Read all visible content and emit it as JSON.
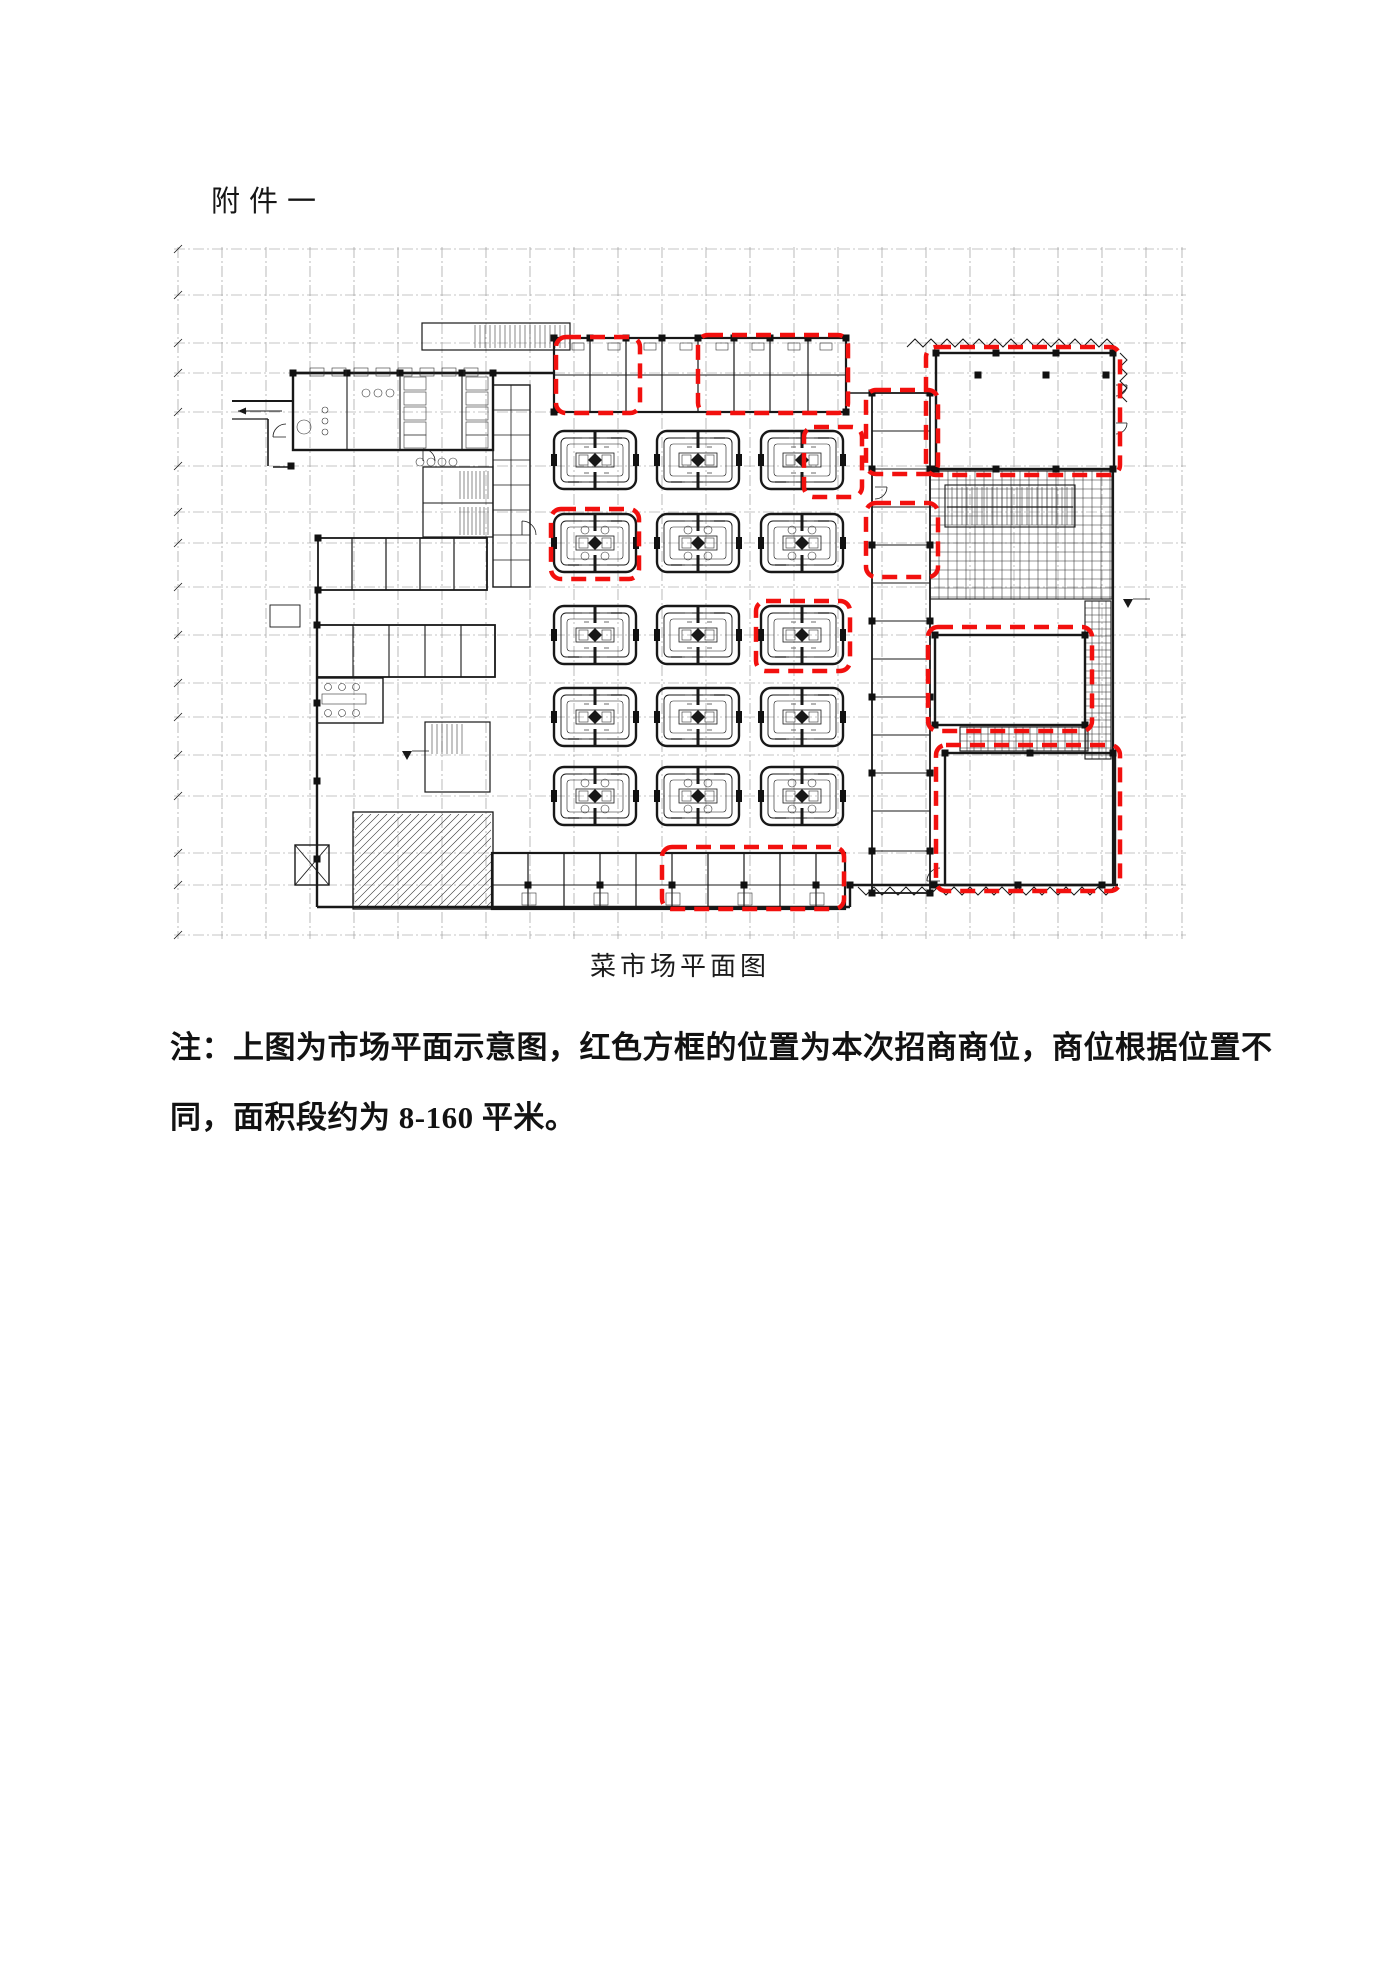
{
  "document": {
    "attachment_title": "附件一",
    "figure_caption": "菜市场平面图",
    "note_line1": "注：上图为市场平面示意图，红色方框的位置为本次招商商位，商位根据位置不",
    "note_line2": "同，面积段约为 8-160 平米。"
  },
  "floorplan": {
    "width": 1020,
    "height": 715,
    "colors": {
      "wall": "#181818",
      "grid": "#8e8e8e",
      "red": "#f2100e",
      "hatch": "#2a2a2a"
    },
    "grid": {
      "verticals": [
        8,
        52,
        96,
        140,
        184,
        228,
        272,
        316,
        360,
        404,
        448,
        492,
        536,
        580,
        624,
        668,
        712,
        756,
        800,
        844,
        888,
        932,
        976,
        1012
      ],
      "horizontals": [
        14,
        60,
        108,
        138,
        177,
        231,
        277,
        308,
        352,
        400,
        448,
        482,
        520,
        561,
        618,
        650,
        700
      ],
      "vy": [
        12,
        704
      ],
      "hx": [
        4,
        1016
      ],
      "tick_x": 8
    },
    "wall_rects": [
      [
        123,
        138,
        200,
        77,
        2.4
      ],
      [
        252,
        88,
        148,
        27,
        1.2
      ],
      [
        384,
        103,
        292,
        74,
        2.2
      ],
      [
        766,
        118,
        178,
        116,
        2.4
      ],
      [
        702,
        158,
        58,
        500,
        1.8
      ],
      [
        148,
        303,
        169,
        52,
        1.8
      ],
      [
        147,
        390,
        178,
        52,
        1.8
      ],
      [
        147,
        443,
        66,
        45,
        1.4
      ],
      [
        322,
        618,
        353,
        56,
        2.2
      ],
      [
        183,
        577,
        140,
        97,
        1.3
      ],
      [
        253,
        232,
        70,
        70,
        1.2
      ],
      [
        255,
        487,
        65,
        70,
        1.2
      ],
      [
        765,
        400,
        150,
        90,
        2.4
      ],
      [
        775,
        518,
        170,
        132,
        2.4
      ],
      [
        100,
        370,
        30,
        22,
        0.9
      ],
      [
        323,
        150,
        37,
        202,
        1.4
      ],
      [
        775,
        250,
        130,
        42,
        1.1
      ]
    ],
    "wall_lines": [
      [
        123,
        138,
        384,
        138,
        2.4
      ],
      [
        98,
        184,
        98,
        231,
        1.6
      ],
      [
        62,
        166,
        123,
        166,
        2.0
      ],
      [
        62,
        184,
        98,
        184,
        1.2
      ],
      [
        103,
        232,
        123,
        232,
        1.4
      ],
      [
        147,
        355,
        147,
        672,
        2.4
      ],
      [
        147,
        672,
        680,
        672,
        2.4
      ],
      [
        680,
        672,
        680,
        650,
        2.4
      ],
      [
        680,
        650,
        948,
        650,
        2.4
      ],
      [
        943,
        234,
        943,
        650,
        2.2
      ],
      [
        676,
        158,
        702,
        158,
        1.4
      ],
      [
        253,
        268,
        323,
        268,
        1.0
      ],
      [
        322,
        650,
        675,
        650,
        0.9
      ],
      [
        384,
        140,
        676,
        140,
        0.9
      ],
      [
        777,
        272,
        903,
        272,
        1.2
      ]
    ],
    "divider_sets": [
      {
        "o": "v",
        "xs": [
          420,
          456,
          492,
          528,
          564,
          600,
          638
        ],
        "a": 103,
        "b": 177,
        "w": 1.2
      },
      {
        "o": "v",
        "xs": [
          358,
          394,
          430,
          466,
          502,
          538,
          574,
          610,
          646
        ],
        "a": 618,
        "b": 674,
        "w": 1.2
      },
      {
        "o": "v",
        "xs": [
          182,
          216,
          250,
          284
        ],
        "a": 303,
        "b": 355,
        "w": 1.2
      },
      {
        "o": "v",
        "xs": [
          183,
          219,
          255,
          291
        ],
        "a": 390,
        "b": 442,
        "w": 1.1
      },
      {
        "o": "h",
        "ys": [
          196,
          234,
          272,
          310,
          348,
          386,
          424,
          462,
          500,
          538,
          576,
          616
        ],
        "a": 702,
        "b": 760,
        "w": 1.0
      },
      {
        "o": "h",
        "ys": [
          175,
          200,
          225,
          250,
          275,
          300,
          325
        ],
        "a": 323,
        "b": 360,
        "w": 0.8
      },
      {
        "o": "v",
        "xs": [
          177,
          230,
          292
        ],
        "a": 138,
        "b": 215,
        "w": 1.1
      },
      {
        "o": "v",
        "xs": [
          341
        ],
        "a": 150,
        "b": 352,
        "w": 0.8
      }
    ],
    "hatches": [
      [
        300,
        90,
        98,
        23,
        "v",
        5,
        0
      ],
      [
        760,
        236,
        182,
        128,
        "g",
        9,
        1
      ],
      [
        915,
        366,
        26,
        158,
        "g",
        7,
        1
      ],
      [
        790,
        492,
        128,
        24,
        "g",
        7,
        1
      ],
      [
        185,
        579,
        136,
        93,
        "d",
        8,
        0
      ],
      [
        286,
        236,
        34,
        28,
        "v",
        4,
        0
      ],
      [
        286,
        272,
        34,
        28,
        "v",
        4,
        0
      ],
      [
        257,
        489,
        40,
        30,
        "v",
        5,
        0
      ],
      [
        777,
        252,
        126,
        38,
        "v",
        5,
        0
      ]
    ],
    "squares": [
      [
        384,
        103
      ],
      [
        420,
        103
      ],
      [
        456,
        103
      ],
      [
        492,
        103
      ],
      [
        528,
        103
      ],
      [
        564,
        103
      ],
      [
        600,
        103
      ],
      [
        638,
        103
      ],
      [
        676,
        103
      ],
      [
        384,
        177
      ],
      [
        676,
        177
      ],
      [
        766,
        118
      ],
      [
        826,
        118
      ],
      [
        886,
        118
      ],
      [
        943,
        118
      ],
      [
        766,
        234
      ],
      [
        826,
        234
      ],
      [
        886,
        234
      ],
      [
        943,
        234
      ],
      [
        808,
        140
      ],
      [
        876,
        140
      ],
      [
        936,
        140
      ],
      [
        702,
        158
      ],
      [
        760,
        158
      ],
      [
        702,
        234
      ],
      [
        760,
        234
      ],
      [
        702,
        310
      ],
      [
        760,
        310
      ],
      [
        702,
        386
      ],
      [
        760,
        386
      ],
      [
        702,
        462
      ],
      [
        760,
        462
      ],
      [
        702,
        538
      ],
      [
        760,
        538
      ],
      [
        702,
        616
      ],
      [
        760,
        616
      ],
      [
        702,
        658
      ],
      [
        760,
        658
      ],
      [
        147,
        390
      ],
      [
        147,
        468
      ],
      [
        147,
        546
      ],
      [
        147,
        624
      ],
      [
        148,
        303
      ],
      [
        148,
        355
      ],
      [
        123,
        138
      ],
      [
        177,
        138
      ],
      [
        230,
        138
      ],
      [
        292,
        138
      ],
      [
        323,
        138
      ],
      [
        358,
        650
      ],
      [
        430,
        650
      ],
      [
        502,
        650
      ],
      [
        574,
        650
      ],
      [
        646,
        650
      ],
      [
        680,
        650
      ],
      [
        764,
        650
      ],
      [
        848,
        650
      ],
      [
        932,
        650
      ],
      [
        765,
        400
      ],
      [
        915,
        400
      ],
      [
        765,
        490
      ],
      [
        915,
        490
      ],
      [
        775,
        518
      ],
      [
        860,
        518
      ],
      [
        943,
        518
      ],
      [
        121,
        231
      ]
    ],
    "circles": [
      [
        134,
        192,
        7
      ],
      [
        155,
        175,
        3
      ],
      [
        155,
        186,
        3
      ],
      [
        155,
        197,
        3
      ],
      [
        196,
        158,
        4
      ],
      [
        208,
        158,
        4
      ],
      [
        220,
        158,
        4
      ],
      [
        250,
        227,
        4
      ],
      [
        261,
        227,
        4
      ],
      [
        272,
        227,
        4
      ],
      [
        283,
        227,
        4
      ],
      [
        158,
        452,
        3.5
      ],
      [
        172,
        452,
        3.5
      ],
      [
        186,
        452,
        3.5
      ],
      [
        158,
        478,
        3.5
      ],
      [
        172,
        478,
        3.5
      ],
      [
        186,
        478,
        3.5
      ]
    ],
    "fixture_rects": [
      [
        140,
        133,
        14,
        8
      ],
      [
        162,
        133,
        14,
        8
      ],
      [
        184,
        133,
        14,
        8
      ],
      [
        206,
        133,
        14,
        8
      ],
      [
        228,
        133,
        14,
        8
      ],
      [
        250,
        133,
        14,
        8
      ],
      [
        272,
        133,
        14,
        8
      ],
      [
        294,
        133,
        14,
        8
      ],
      [
        234,
        142,
        22,
        13
      ],
      [
        234,
        157,
        22,
        13
      ],
      [
        234,
        172,
        22,
        13
      ],
      [
        234,
        187,
        22,
        13
      ],
      [
        234,
        200,
        22,
        13
      ],
      [
        296,
        142,
        22,
        13
      ],
      [
        296,
        157,
        22,
        13
      ],
      [
        296,
        172,
        22,
        13
      ],
      [
        296,
        187,
        22,
        13
      ],
      [
        296,
        200,
        22,
        13
      ],
      [
        152,
        459,
        44,
        10
      ],
      [
        352,
        658,
        14,
        12
      ],
      [
        424,
        658,
        14,
        12
      ],
      [
        496,
        658,
        14,
        12
      ],
      [
        568,
        658,
        14,
        12
      ],
      [
        640,
        658,
        14,
        12
      ],
      [
        402,
        108,
        12,
        7
      ],
      [
        438,
        108,
        12,
        7
      ],
      [
        474,
        108,
        12,
        7
      ],
      [
        510,
        108,
        12,
        7
      ],
      [
        546,
        108,
        12,
        7
      ],
      [
        582,
        108,
        12,
        7
      ],
      [
        618,
        108,
        12,
        7
      ],
      [
        650,
        108,
        12,
        7
      ]
    ],
    "arcs": [
      [
        116,
        202,
        13,
        3
      ],
      [
        253,
        226,
        12,
        0
      ],
      [
        352,
        300,
        14,
        0
      ],
      [
        705,
        252,
        12,
        1
      ],
      [
        770,
        646,
        13,
        3
      ],
      [
        946,
        150,
        11,
        1
      ],
      [
        946,
        188,
        11,
        1
      ]
    ],
    "zigzags": [
      {
        "x": 737,
        "y": 112,
        "len": 211,
        "step": 16,
        "amp": 8,
        "dir": "up"
      },
      {
        "x": 688,
        "y": 652,
        "len": 258,
        "step": 16,
        "amp": 8,
        "dir": "down"
      },
      {
        "x": 950,
        "y": 118,
        "len": 56,
        "step": 14,
        "amp": 7,
        "dir": "right"
      }
    ],
    "triangles": [
      [
        237,
        520
      ],
      [
        958,
        368
      ]
    ],
    "arrow": {
      "x1": 112,
      "y1": 176,
      "x2": 68,
      "y2": 176
    },
    "elevator": {
      "x": 125,
      "y": 610,
      "w": 34,
      "h": 40
    },
    "islands": {
      "cols": [
        425,
        528,
        632
      ],
      "rows": [
        225,
        308,
        400,
        482,
        561
      ],
      "w": 82,
      "h": 58,
      "circle_rows": [
        1,
        4
      ]
    },
    "red_boxes": [
      [
        386,
        102,
        84,
        76
      ],
      [
        528,
        100,
        150,
        78
      ],
      [
        756,
        112,
        194,
        128
      ],
      [
        696,
        155,
        72,
        84
      ],
      [
        696,
        268,
        72,
        74
      ],
      [
        381,
        274,
        88,
        70
      ],
      [
        634,
        192,
        58,
        70
      ],
      [
        586,
        366,
        94,
        70
      ],
      [
        758,
        392,
        164,
        104
      ],
      [
        766,
        510,
        184,
        146
      ],
      [
        492,
        612,
        182,
        62
      ]
    ],
    "red_style": {
      "width": 4.5,
      "dash": "15 9",
      "rx": 10
    }
  }
}
